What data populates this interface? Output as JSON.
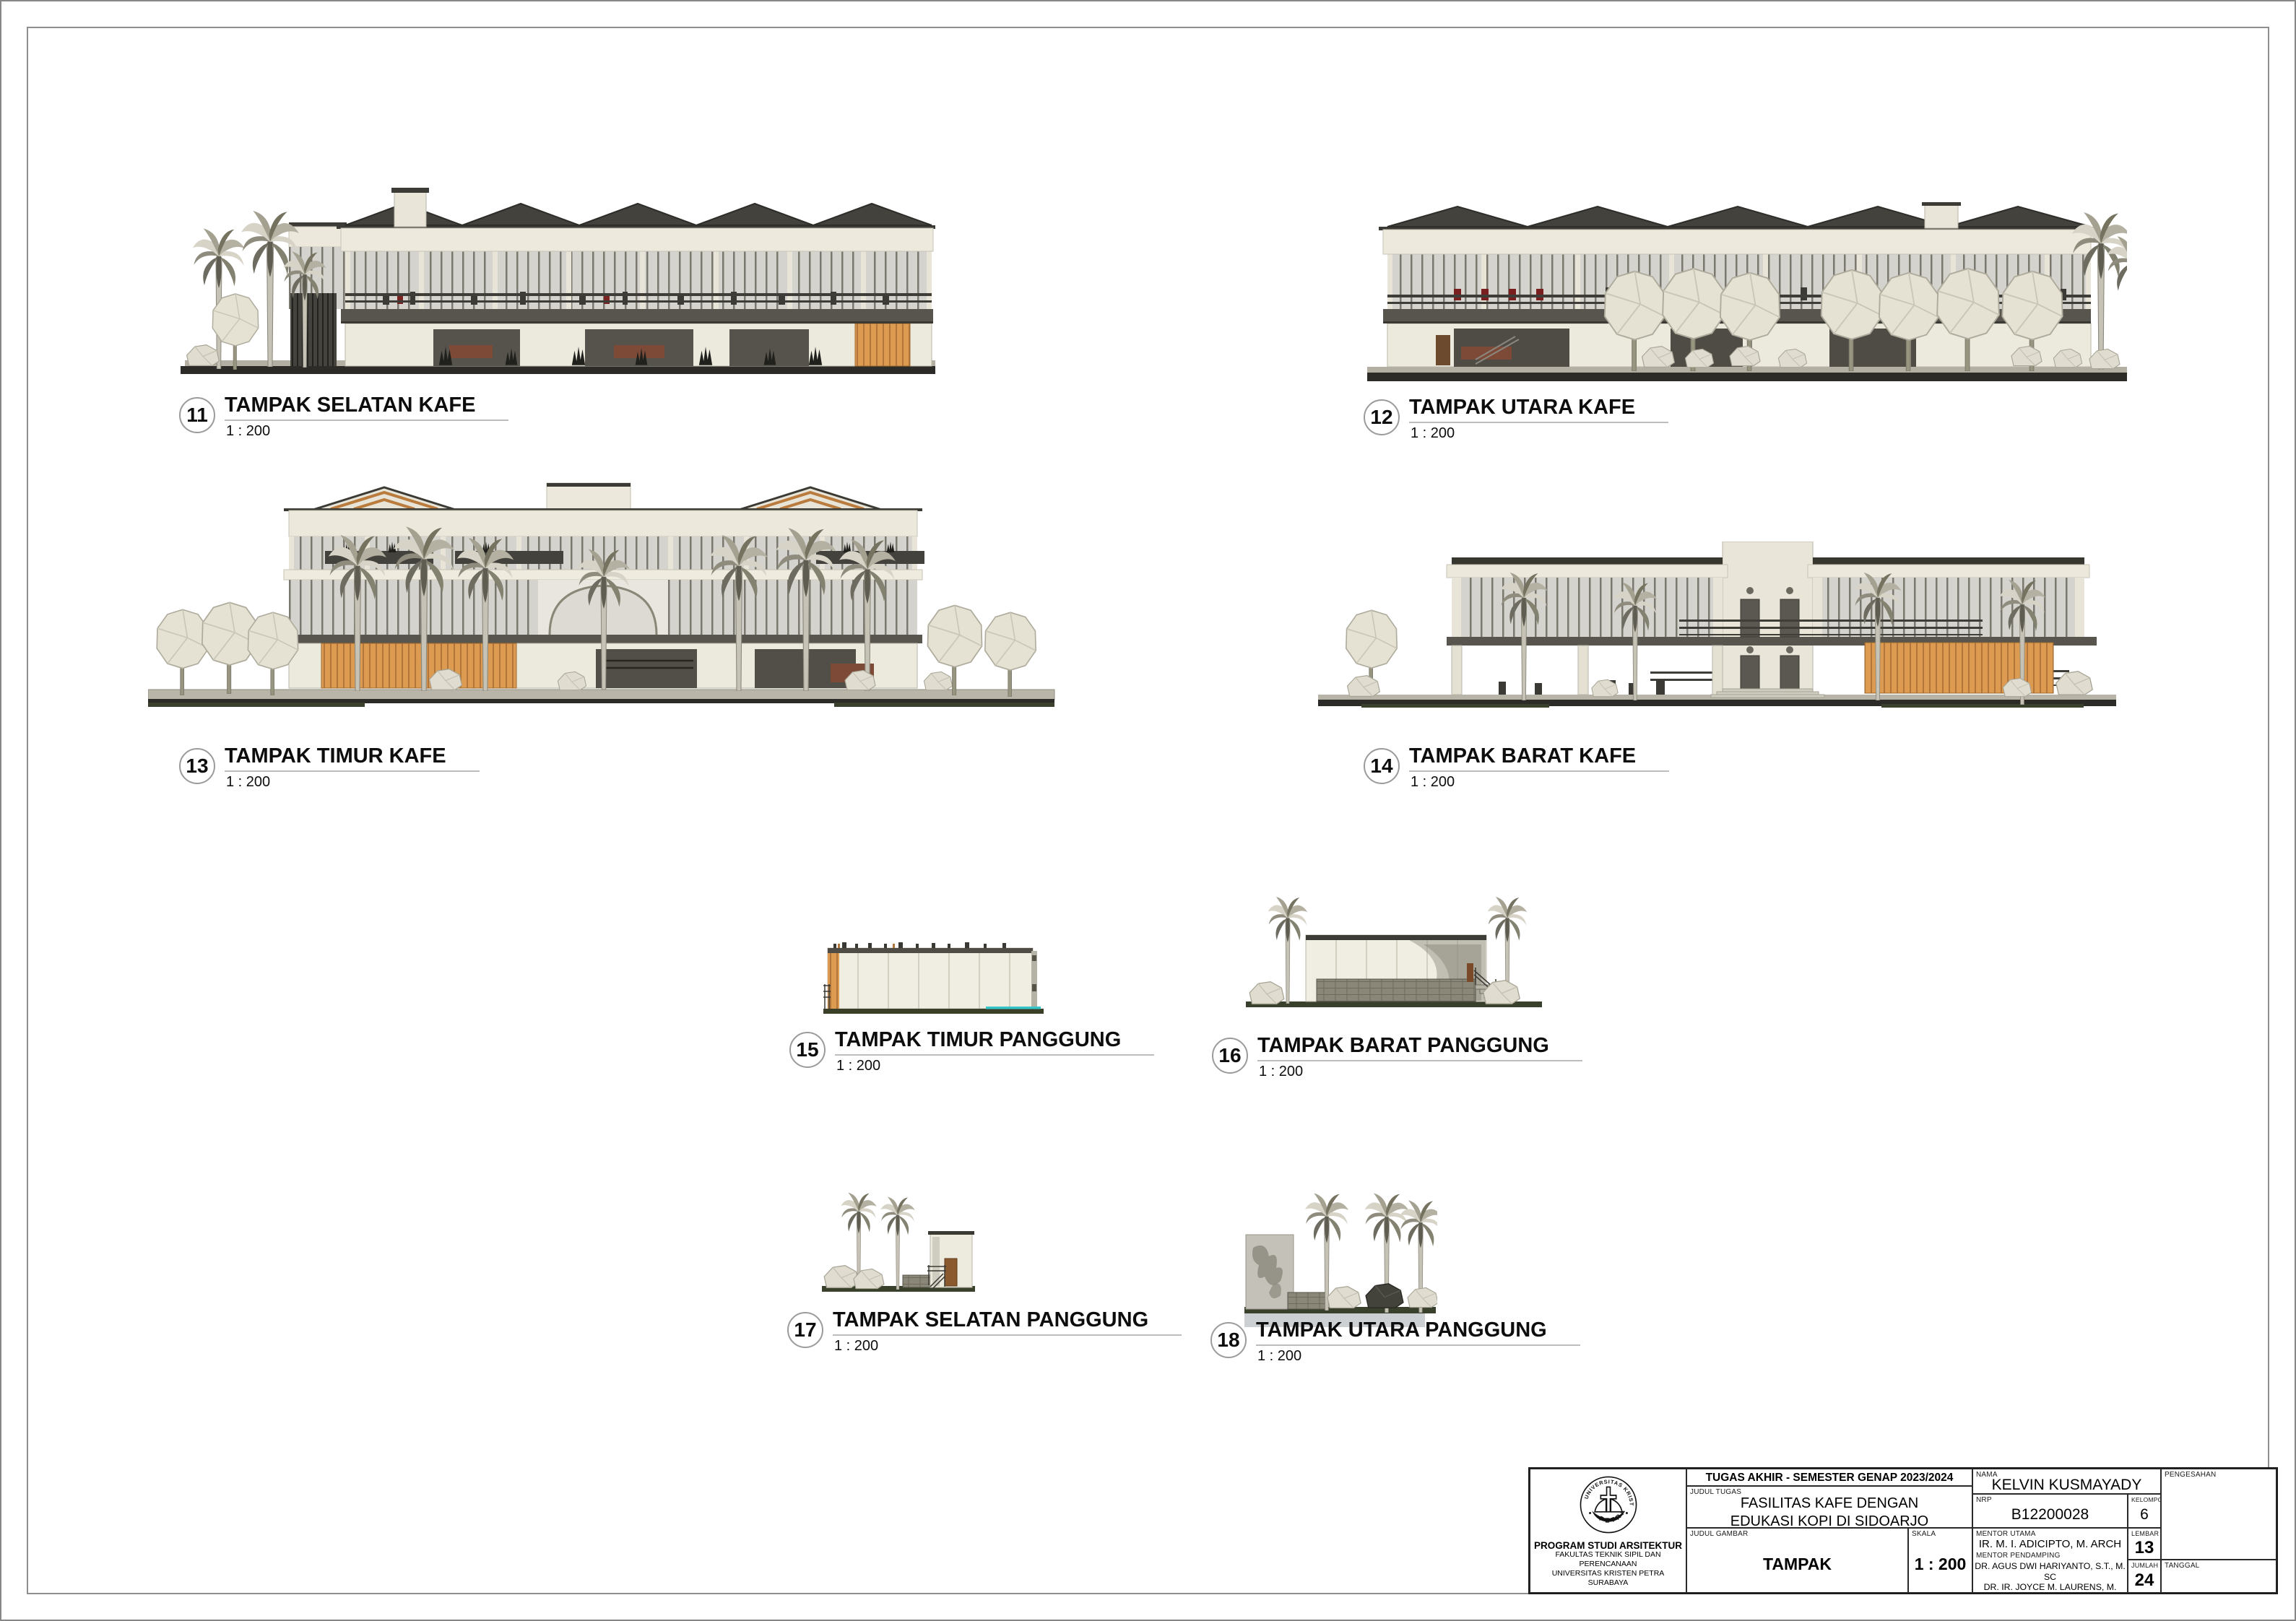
{
  "sheet": {
    "type": "architectural elevation sheet",
    "colors": {
      "wood_accent": "#db9a51",
      "roof_dark": "#3c3b35",
      "teal_accent": "#35c4c8",
      "tree_gray": "#c6c3b6",
      "grass": "#39402b"
    }
  },
  "drawings": [
    {
      "number": "11",
      "title": "TAMPAK SELATAN KAFE",
      "scale": "1 : 200"
    },
    {
      "number": "12",
      "title": "TAMPAK UTARA KAFE",
      "scale": "1 : 200"
    },
    {
      "number": "13",
      "title": "TAMPAK TIMUR KAFE",
      "scale": "1 : 200"
    },
    {
      "number": "14",
      "title": "TAMPAK BARAT KAFE",
      "scale": "1 : 200"
    },
    {
      "number": "15",
      "title": "TAMPAK TIMUR PANGGUNG",
      "scale": "1 : 200"
    },
    {
      "number": "16",
      "title": "TAMPAK BARAT PANGGUNG",
      "scale": "1 : 200"
    },
    {
      "number": "17",
      "title": "TAMPAK SELATAN PANGGUNG",
      "scale": "1 : 200"
    },
    {
      "number": "18",
      "title": "TAMPAK UTARA PANGGUNG",
      "scale": "1 : 200"
    }
  ],
  "title_block": {
    "header": "TUGAS AKHIR - SEMESTER GENAP 2023/2024",
    "judul_tugas_label": "JUDUL TUGAS",
    "judul_tugas_line1": "FASILITAS KAFE DENGAN",
    "judul_tugas_line2": "EDUKASI KOPI DI SIDOARJO",
    "judul_gambar_label": "JUDUL GAMBAR",
    "judul_gambar": "TAMPAK",
    "skala_label": "SKALA",
    "skala": "1 : 200",
    "nama_label": "NAMA",
    "nama": "KELVIN KUSMAYADY",
    "nrp_label": "NRP",
    "nrp": "B12200028",
    "kelompok_label": "KELOMPOK",
    "kelompok": "6",
    "mentor_utama_label": "MENTOR UTAMA",
    "mentor_utama": "IR. M. I. ADICIPTO, M. ARCH",
    "mentor_pendamping_label": "MENTOR PENDAMPING",
    "mentor_pendamping_1": "DR. AGUS DWI HARIYANTO, S.T., M. SC",
    "mentor_pendamping_2": "DR. IR. JOYCE M. LAURENS, M. ARCH",
    "mentor_pendamping_3": "STEPHANUS WIRAWAN D., S.T., M. ARS.",
    "lembar_label": "LEMBAR",
    "lembar": "13",
    "jumlah_label": "JUMLAH",
    "jumlah": "24",
    "tanggal_label": "TANGGAL",
    "pengesahan_label": "PENGESAHAN",
    "institution": {
      "line1": "PROGRAM STUDI ARSITEKTUR",
      "line2": "FAKULTAS TEKNIK SIPIL DAN PERENCANAAN",
      "line3": "UNIVERSITAS KRISTEN PETRA",
      "line4": "SURABAYA",
      "logo_top": "UNIVERSITAS KRISTEN",
      "logo_bottom": "PETRA"
    }
  }
}
